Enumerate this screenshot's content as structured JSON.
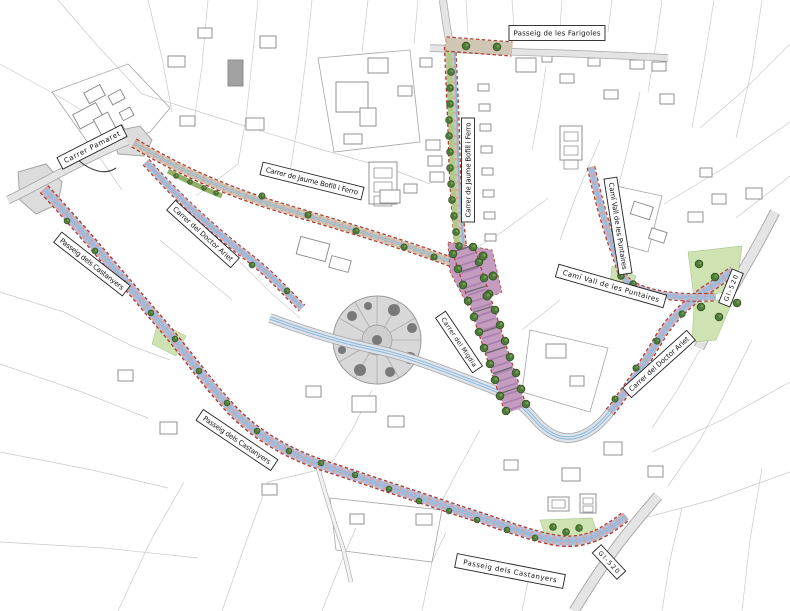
{
  "map": {
    "type": "urban-plan-site-map",
    "street_labels": [
      {
        "id": "carrer-pamaret",
        "text": "Carrer Pamaret"
      },
      {
        "id": "passeig-de-les-farigoles",
        "text": "Passeig de les Farigoles"
      },
      {
        "id": "carrer-de-jaume-bofill-i-ferro-1",
        "text": "Carrer de Jaume Bofill i Ferro"
      },
      {
        "id": "carrer-de-jaume-bofill-i-ferro-2",
        "text": "Carrer de Jaume Bofill i Ferro"
      },
      {
        "id": "cami-vall-de-les-puntaires-1",
        "text": "Camí Vall de les Puntaires"
      },
      {
        "id": "cami-vall-de-les-puntaires-2",
        "text": "Camí Vall de les Puntaires"
      },
      {
        "id": "carrer-del-doctor-ariet-1",
        "text": "Carrer del Doctor Ariet"
      },
      {
        "id": "carrer-del-doctor-ariet-2",
        "text": "Carrer del Doctor Ariet"
      },
      {
        "id": "carrer-del-migdia",
        "text": "Carrer del Migdia"
      },
      {
        "id": "passeig-dels-castanyers-1",
        "text": "Passeig dels Castanyers"
      },
      {
        "id": "passeig-dels-castanyers-2",
        "text": "Passeig dels Castanyers"
      },
      {
        "id": "passeig-dels-castanyers-3",
        "text": "Passeig dels Castanyers"
      },
      {
        "id": "gi-520-1",
        "text": "GI-520"
      },
      {
        "id": "gi-520-2",
        "text": "GI-520"
      }
    ],
    "symbols": {
      "tree_icon": "dark green tree circle",
      "roundabout_plaza": "gray radial-paved circular plaza"
    },
    "colors": {
      "project_street_fill": "#b3bcd8",
      "street_edge_red": "#b23b2e",
      "axis_blue": "#88b8dc",
      "promenade_purple": "#c49cc0",
      "tree_green": "#4d7a3a",
      "green_area": "#cfe2b2",
      "existing_road": "#e4e4e4",
      "parcel_line": "#c9c9c9"
    }
  }
}
